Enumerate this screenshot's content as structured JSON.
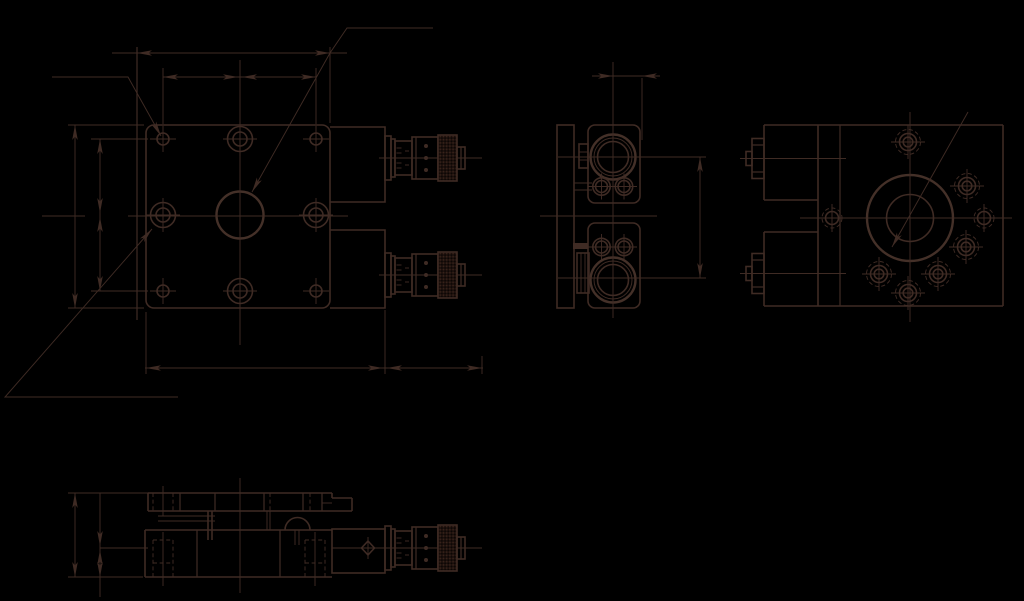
{
  "canvas": {
    "width": 1024,
    "height": 601,
    "background_color": "#000000",
    "line_color": "#3f2b24",
    "bold_line_color": "#443028"
  },
  "drawing": {
    "kind": "cad-engineering-drawing",
    "text_labels": [],
    "views": [
      {
        "name": "front-view",
        "features": [
          "square-plate",
          "3x3-mounting-hole-grid",
          "center-bore",
          "two-micrometer-heads",
          "chained-dimension-lines",
          "leader-lines"
        ]
      },
      {
        "name": "side-view",
        "features": [
          "clamp-column",
          "two-micrometer-clamp-blocks",
          "bores",
          "offset-dimension",
          "spacing-dimension"
        ]
      },
      {
        "name": "rear-view",
        "features": [
          "center-bore",
          "bolt-hole-pattern",
          "micrometer-knob-ends",
          "leader-line"
        ]
      },
      {
        "name": "bottom-view",
        "features": [
          "stage-side-section",
          "hidden-counterbore-holes",
          "micrometer-head",
          "height-dimensions"
        ]
      }
    ]
  }
}
